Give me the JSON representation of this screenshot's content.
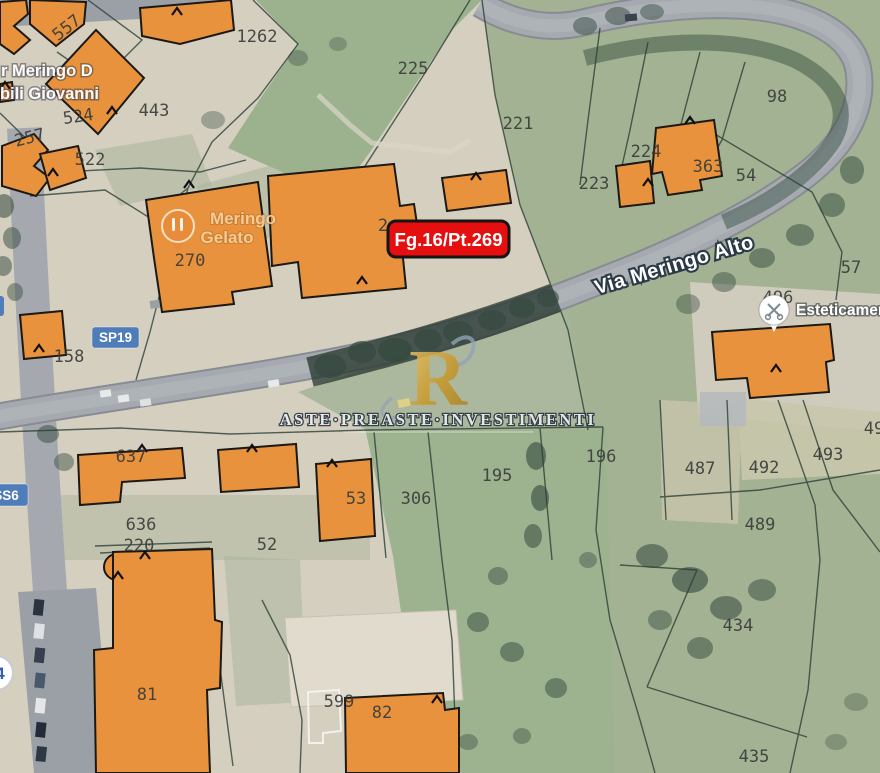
{
  "map": {
    "parcel_numbers": [
      {
        "t": "557",
        "x": 70,
        "y": 32,
        "r": -38
      },
      {
        "t": "1262",
        "x": 257,
        "y": 42
      },
      {
        "t": "225",
        "x": 413,
        "y": 74
      },
      {
        "t": "221",
        "x": 518,
        "y": 129
      },
      {
        "t": "98",
        "x": 777,
        "y": 102
      },
      {
        "t": "223",
        "x": 594,
        "y": 189
      },
      {
        "t": "224",
        "x": 646,
        "y": 157,
        "s": 15
      },
      {
        "t": "363",
        "x": 708,
        "y": 172
      },
      {
        "t": "54",
        "x": 746,
        "y": 181
      },
      {
        "t": "443",
        "x": 154,
        "y": 116
      },
      {
        "t": "524",
        "x": 79,
        "y": 122,
        "r": -8
      },
      {
        "t": "522",
        "x": 90,
        "y": 165
      },
      {
        "t": "257",
        "x": 31,
        "y": 143,
        "r": -14
      },
      {
        "t": "270",
        "x": 190,
        "y": 266
      },
      {
        "t": "2",
        "x": 383,
        "y": 231,
        "s": 15
      },
      {
        "t": "158",
        "x": 69,
        "y": 362
      },
      {
        "t": "496",
        "x": 778,
        "y": 303
      },
      {
        "t": "57",
        "x": 851,
        "y": 273
      },
      {
        "t": "487",
        "x": 700,
        "y": 474
      },
      {
        "t": "492",
        "x": 764,
        "y": 473
      },
      {
        "t": "493",
        "x": 828,
        "y": 460
      },
      {
        "t": "49",
        "x": 874,
        "y": 434
      },
      {
        "t": "489",
        "x": 760,
        "y": 530
      },
      {
        "t": "434",
        "x": 738,
        "y": 631
      },
      {
        "t": "435",
        "x": 754,
        "y": 762
      },
      {
        "t": "637",
        "x": 131,
        "y": 462
      },
      {
        "t": "636",
        "x": 141,
        "y": 530
      },
      {
        "t": "220",
        "x": 139,
        "y": 551
      },
      {
        "t": "52",
        "x": 267,
        "y": 550
      },
      {
        "t": "53",
        "x": 356,
        "y": 504
      },
      {
        "t": "306",
        "x": 416,
        "y": 504
      },
      {
        "t": "195",
        "x": 497,
        "y": 481
      },
      {
        "t": "196",
        "x": 601,
        "y": 462
      },
      {
        "t": "599",
        "x": 339,
        "y": 707
      },
      {
        "t": "81",
        "x": 147,
        "y": 700
      },
      {
        "t": "82",
        "x": 382,
        "y": 718
      }
    ],
    "street_label": "Via Meringo Alto",
    "badges": {
      "sp19": "SP19",
      "ss6": "SS6",
      "n4": "4"
    },
    "poi": {
      "meringo_line1": "Meringo",
      "meringo_line2": "Gelato",
      "estetica": "Esteticamente"
    },
    "place_text": {
      "line1": "r Meringo D",
      "line2": "bili Giovanni"
    },
    "marker": {
      "text": "Fg.16/Pt.269",
      "bg": "#e60f0f"
    },
    "watermark": {
      "monogram": "R",
      "text": "ASTE·PREASTE·INVESTIMENTI"
    },
    "colors": {
      "building_orange": "#e8923d",
      "field_green": "#a3b293",
      "road_gray": "#a6aab0",
      "badge_blue": "#4e7db9",
      "marker_red": "#e60f0f",
      "watermark_gold": "#c99b2f"
    }
  }
}
